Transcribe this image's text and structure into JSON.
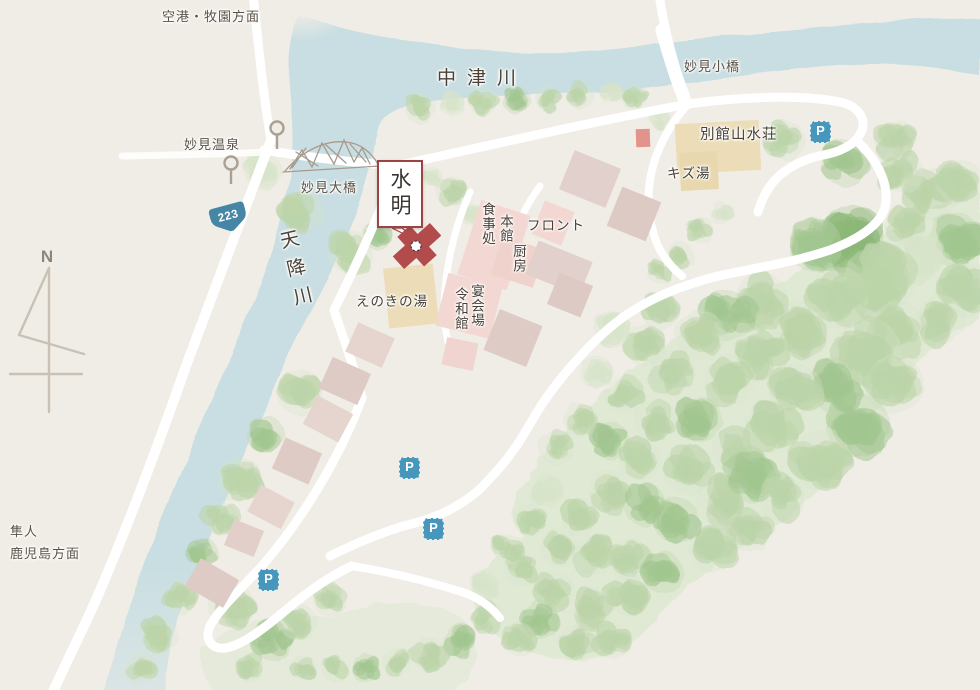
{
  "map": {
    "compass_label": "N",
    "route_number": "223",
    "parking_label": "P",
    "directions": {
      "airport": "空港・牧園方面",
      "hayato_line1": "隼人",
      "hayato_line2": "鹿児島方面"
    },
    "rivers": {
      "nakatsu": "中津川",
      "amori": "天降川"
    },
    "landmarks": {
      "onsen": "妙見温泉",
      "ohashi": "妙見大橋",
      "kobashi": "妙見小橋"
    },
    "highlight": {
      "name": "水明"
    },
    "facilities": {
      "bekkan": "別館山水荘",
      "kizuyu": "キズ湯",
      "front": "フロント",
      "honkan": "本館",
      "shokuji": "食事処",
      "chubo": "厨房",
      "enkai": "宴会場",
      "reiwa": "令和館",
      "enoki": "えのきの湯"
    },
    "colors": {
      "land": "#f0ede6",
      "river": "#c6dde2",
      "road": "#ffffff",
      "tree_light": "#d7e4c9",
      "tree_dark": "#8cb778",
      "building_pink": "#f3d7d2",
      "building_mauve": "#e1d0cb",
      "building_tan": "#ecddb8",
      "highlight_red": "#b24c4c",
      "parking_blue": "#4797bd",
      "route_blue": "#4585a6"
    }
  }
}
